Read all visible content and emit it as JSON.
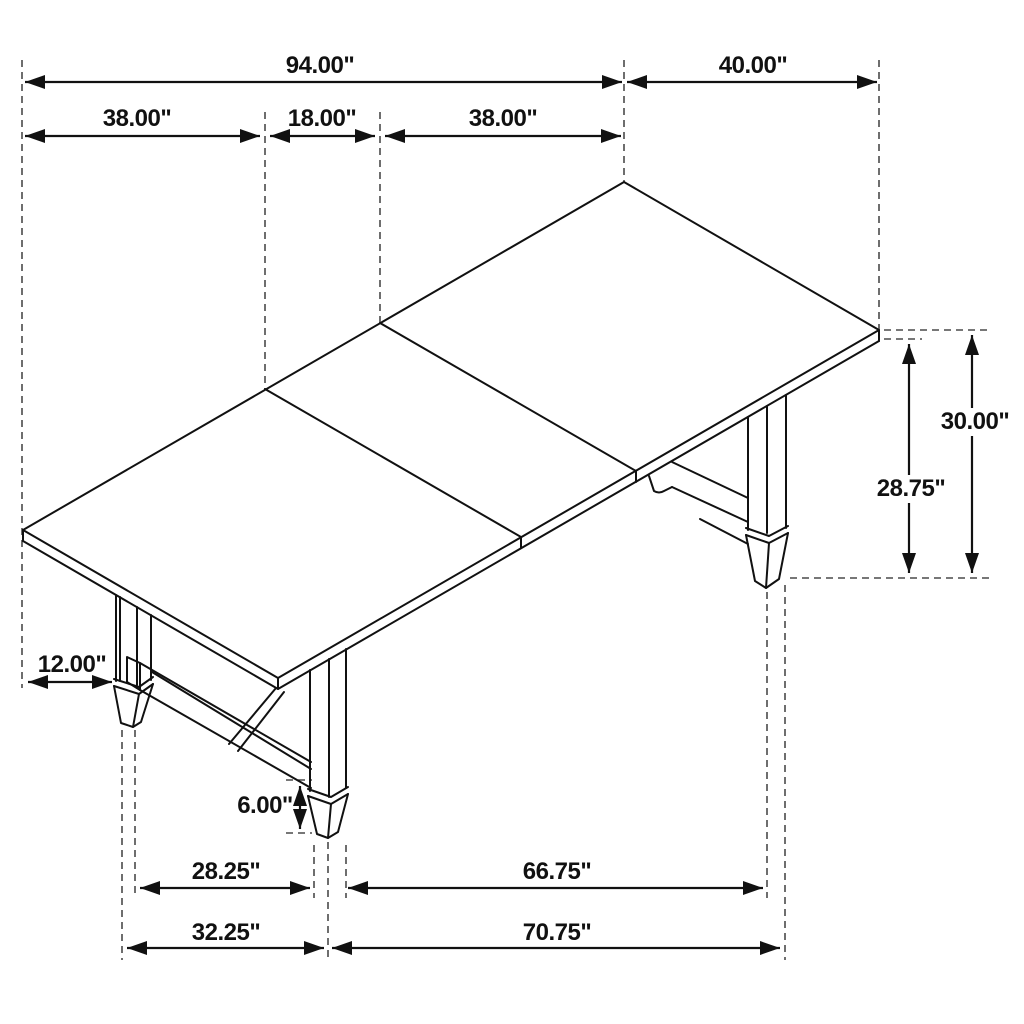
{
  "diagram": {
    "type": "furniture-dimension-drawing",
    "subject": "extendable trestle dining table, isometric line view",
    "unit": "inches",
    "colors": {
      "line": "#111111",
      "extension_line": "#4a4a4a",
      "background": "#ffffff"
    },
    "dimensions": {
      "overall_length": "94.00\"",
      "left_section": "38.00\"",
      "center_leaf": "18.00\"",
      "right_section": "38.00\"",
      "table_width": "40.00\"",
      "table_height": "30.00\"",
      "underside_height": "28.75\"",
      "end_overhang": "12.00\"",
      "foot_height": "6.00\"",
      "base_span_left_inner": "28.25\"",
      "base_span_right_inner": "66.75\"",
      "base_span_left_outer": "32.25\"",
      "base_span_right_outer": "70.75\""
    }
  }
}
